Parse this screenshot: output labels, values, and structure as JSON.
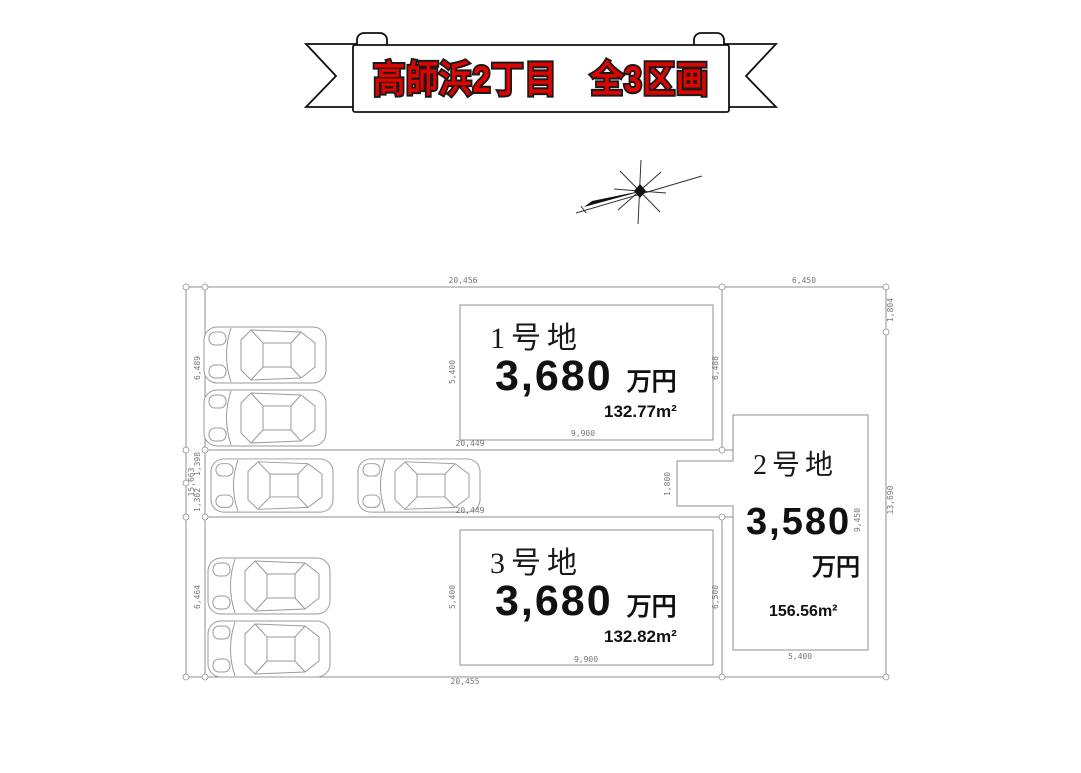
{
  "banner": {
    "title": "高師浜2丁目　全3区画",
    "text_color": "#dd0500",
    "outline_color": "#1a1a1a"
  },
  "compass": {
    "type": "north-arrow-star"
  },
  "lots": [
    {
      "name": "1号地",
      "price_value": "3,680",
      "price_unit": "万円",
      "area": "132.77m²"
    },
    {
      "name": "2号地",
      "price_value": "3,580",
      "price_unit": "万円",
      "area": "156.56m²"
    },
    {
      "name": "3号地",
      "price_value": "3,680",
      "price_unit": "万円",
      "area": "132.82m²"
    }
  ],
  "dims": {
    "top_main": "20,456",
    "top_right": "6,450",
    "right_upper": "1,804",
    "right_lower": "13,690",
    "left_outer": "15,663",
    "left_top": "6,489",
    "left_mid_a": "1,398",
    "left_mid_b": "1,302",
    "left_bottom": "6,464",
    "lot1_left": "5,400",
    "lot1_right": "6,488",
    "lot1_width": "9,900",
    "mid_upper": "20,449",
    "mid_lower": "20,449",
    "notch": "1,800",
    "lot3_left": "5,400",
    "lot3_right": "6,500",
    "lot3_width": "9,900",
    "bottom_outer": "20,455",
    "lot2_right": "9,450",
    "lot2_bottom": "5,400"
  },
  "cars_count": 6
}
